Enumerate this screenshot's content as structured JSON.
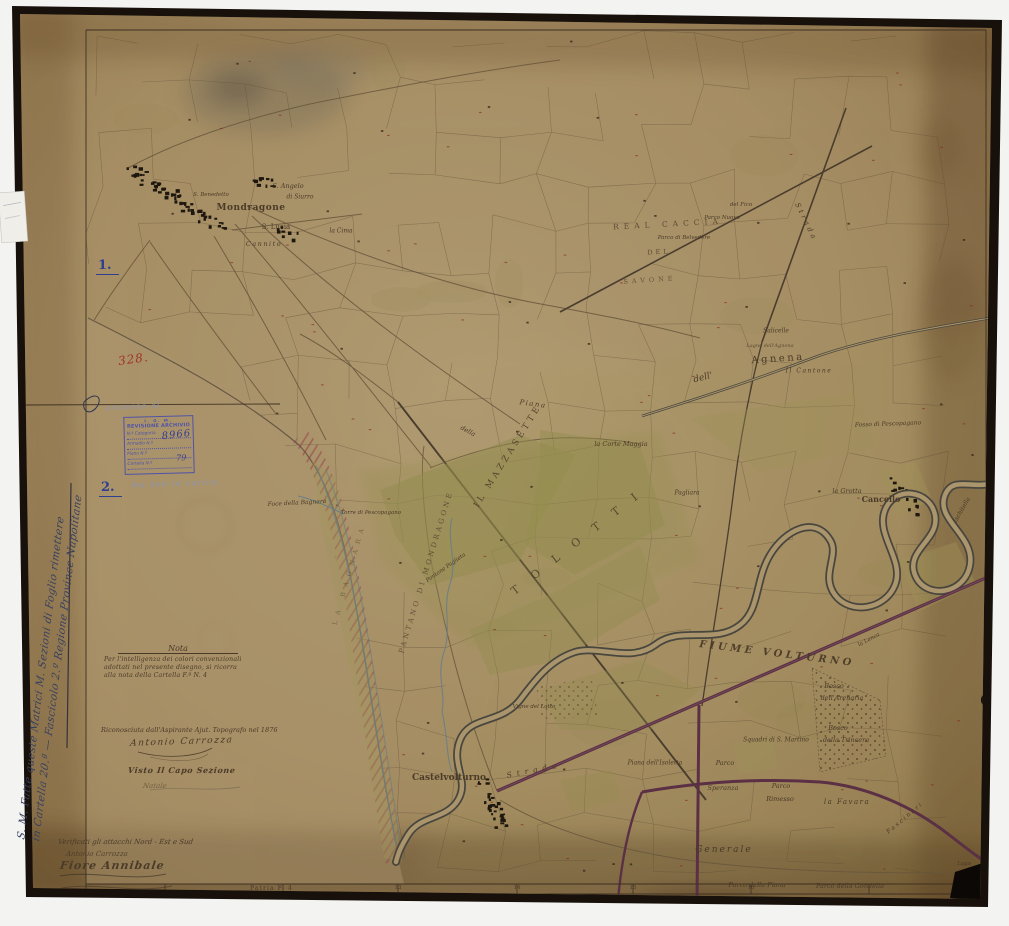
{
  "colors": {
    "paper": "#c8ac7a",
    "ink": "#4a3a28",
    "blue_ink": "#2e3f8f",
    "red_ink": "#9e3425",
    "stamp_blue": "#4f52a8",
    "road_purple": "#6e3a52",
    "river_gray": "#57544a",
    "channel_blue": "#7e98a0",
    "field_green": "#b0a85e",
    "dune_red": "#b05056"
  },
  "margin": {
    "item1": "1.",
    "item2": "2.",
    "number_red": "328.",
    "rotated_note": {
      "line1": "S. M. Fatte queste Matrici M. Sezioni di Foglio rimettere",
      "line2": "in Cartella 20.ª — Fascicolo 2.º Regione Province Napolitane"
    },
    "pencil_above_stamp": "annesso al",
    "pencil_below_stamp": "ma non in carico",
    "stamp": {
      "line1": "I. G. M.",
      "line2": "REVISIONE ARCHIVIO",
      "rows": [
        {
          "label": "N.ª Categoria",
          "value": "8966"
        },
        {
          "label": "Armadio N.º",
          "value": ""
        },
        {
          "label": "Piano N.º",
          "value": "79"
        },
        {
          "label": "Cartella N.º",
          "value": ""
        }
      ]
    },
    "nota": {
      "title": "Nota",
      "lines": [
        "Per l'intelligenza dei colori convenzionali",
        "adottati nel presente disegno, si ricorra",
        "alla nota della Cartella F.ª N. 4"
      ]
    },
    "recognition": {
      "line": "Riconosciuta dall'Aspirante Ajut. Topografo nel 1876",
      "signature": "Antonio Carrozza"
    },
    "visto": {
      "line": "Visto Il Capo Sezione",
      "signature": "Natale"
    },
    "verification": {
      "lines": [
        "Verificati gli attacchi Nord - Est e Sud",
        "Antonio Carrozza",
        "Fiore Annibale"
      ]
    }
  },
  "border": {
    "bottom_label": "Patria F. 4",
    "ticks": [
      {
        "label": "13",
        "x": 398
      },
      {
        "label": "14",
        "x": 517
      },
      {
        "label": "15",
        "x": 633
      },
      {
        "label": "16",
        "x": 751
      }
    ]
  },
  "map": {
    "labels": [
      {
        "t": "Mondragone",
        "x": 251,
        "y": 208,
        "s": 9,
        "st": "rm",
        "ls": 0.5,
        "w": 700
      },
      {
        "t": "S. Angelo",
        "x": 288,
        "y": 186,
        "s": 6.5
      },
      {
        "t": "di Siurro",
        "x": 300,
        "y": 197,
        "s": 6
      },
      {
        "t": "S. Lucia",
        "x": 276,
        "y": 227,
        "s": 7,
        "st": "rm"
      },
      {
        "t": "S. Benedetto",
        "x": 211,
        "y": 195,
        "s": 5.5
      },
      {
        "t": "la Cima",
        "x": 341,
        "y": 231,
        "s": 6
      },
      {
        "t": "Cannito",
        "x": 264,
        "y": 244,
        "s": 6.5,
        "ls": 1.5
      },
      {
        "t": "IL MAZZASETTE",
        "x": 508,
        "y": 456,
        "r": -58,
        "s": 8.5,
        "ls": 3.5,
        "st": "rm",
        "o": 0.9
      },
      {
        "t": "T O L O T T I",
        "x": 577,
        "y": 542,
        "r": -38,
        "s": 11,
        "ls": 7,
        "st": "rm",
        "o": 0.85
      },
      {
        "t": "PANTANO DI MONDRAGONE",
        "x": 426,
        "y": 572,
        "r": -73,
        "s": 7,
        "ls": 3,
        "st": "rm",
        "o": 0.75
      },
      {
        "t": "LA BAGNARA",
        "x": 349,
        "y": 574,
        "r": -74,
        "s": 6.5,
        "ls": 6,
        "st": "rm",
        "o": 0.5
      },
      {
        "t": "FIUME VOLTURNO",
        "x": 777,
        "y": 654,
        "r": 7,
        "s": 10,
        "ls": 3.5,
        "w": 700,
        "o": 0.95
      },
      {
        "t": "Agnena",
        "x": 778,
        "y": 359,
        "r": -4,
        "s": 10,
        "ls": 2.5,
        "st": "rm"
      },
      {
        "t": "Lagno dell'Agnena",
        "x": 770,
        "y": 346,
        "s": 5,
        "o": 0.8
      },
      {
        "t": "dell'",
        "x": 703,
        "y": 378,
        "r": -15,
        "s": 9
      },
      {
        "t": "Il Cantone",
        "x": 809,
        "y": 371,
        "s": 6,
        "ls": 1.5
      },
      {
        "t": "REAL CACCIA",
        "x": 668,
        "y": 224,
        "r": -3,
        "s": 7.5,
        "ls": 5,
        "st": "rm",
        "o": 0.8
      },
      {
        "t": "DEL",
        "x": 659,
        "y": 252,
        "r": -3,
        "s": 6.5,
        "ls": 3,
        "st": "rm",
        "o": 0.8
      },
      {
        "t": "SAVONE",
        "x": 650,
        "y": 280,
        "r": -4,
        "s": 6.5,
        "ls": 4,
        "st": "rm",
        "o": 0.7
      },
      {
        "t": "del Fico",
        "x": 741,
        "y": 205,
        "s": 5.5
      },
      {
        "t": "Parco Nuovo",
        "x": 722,
        "y": 218,
        "s": 5.5
      },
      {
        "t": "Parco di Belvedere",
        "x": 684,
        "y": 238,
        "s": 5.5
      },
      {
        "t": "Salicelle",
        "x": 776,
        "y": 331,
        "s": 6
      },
      {
        "t": "Strada",
        "x": 806,
        "y": 222,
        "r": 64,
        "s": 7,
        "ls": 3
      },
      {
        "t": "Fosso di Pescopagano",
        "x": 888,
        "y": 424,
        "r": -2,
        "s": 6
      },
      {
        "t": "la Grotta",
        "x": 847,
        "y": 491,
        "s": 6.5
      },
      {
        "t": "Cancello",
        "x": 881,
        "y": 499,
        "s": 8,
        "st": "rm",
        "w": 700
      },
      {
        "t": "Ischitella",
        "x": 962,
        "y": 510,
        "r": -60,
        "s": 6
      },
      {
        "t": "la Lanca",
        "x": 869,
        "y": 640,
        "r": -28,
        "s": 5.5
      },
      {
        "t": "Piana",
        "x": 533,
        "y": 404,
        "r": 8,
        "s": 7,
        "ls": 1.5
      },
      {
        "t": "della",
        "x": 468,
        "y": 431,
        "r": 28,
        "s": 6.5
      },
      {
        "t": "la Corte Maggia",
        "x": 621,
        "y": 444,
        "s": 6.5
      },
      {
        "t": "Pagliara",
        "x": 687,
        "y": 493,
        "s": 6
      },
      {
        "t": "Pontone Paglieta",
        "x": 446,
        "y": 568,
        "r": -35,
        "s": 5.5
      },
      {
        "t": "Foce della Bagnara",
        "x": 297,
        "y": 503,
        "r": -3,
        "s": 6
      },
      {
        "t": "Torre di Pescopagano",
        "x": 371,
        "y": 513,
        "s": 5.5
      },
      {
        "t": "Vigne del Lotto",
        "x": 534,
        "y": 707,
        "s": 5.5
      },
      {
        "t": "Strada",
        "x": 534,
        "y": 770,
        "r": -11,
        "s": 7.5,
        "ls": 5
      },
      {
        "t": "Castelvolturno",
        "x": 449,
        "y": 778,
        "s": 9,
        "st": "rm",
        "w": 700
      },
      {
        "t": "Piana dell'Isoletta",
        "x": 655,
        "y": 763,
        "s": 6
      },
      {
        "t": "Squadri di S. Martino",
        "x": 776,
        "y": 740,
        "s": 6
      },
      {
        "t": "Bosco",
        "x": 838,
        "y": 728,
        "s": 6.5
      },
      {
        "t": "della Trincera",
        "x": 846,
        "y": 740,
        "s": 6.5
      },
      {
        "t": "Bosco",
        "x": 834,
        "y": 686,
        "s": 6.5
      },
      {
        "t": "dell'Arenaria",
        "x": 842,
        "y": 698,
        "s": 6.5
      },
      {
        "t": "la Favara",
        "x": 847,
        "y": 802,
        "s": 7,
        "ls": 1.5
      },
      {
        "t": "Parco",
        "x": 725,
        "y": 763,
        "s": 6.5
      },
      {
        "t": "Speranza",
        "x": 723,
        "y": 788,
        "s": 6.5
      },
      {
        "t": "Parco",
        "x": 781,
        "y": 786,
        "s": 6.5
      },
      {
        "t": "Rimesso",
        "x": 780,
        "y": 799,
        "s": 6.5
      },
      {
        "t": "Generale",
        "x": 724,
        "y": 850,
        "s": 9,
        "ls": 2
      },
      {
        "t": "Parco della Piana",
        "x": 757,
        "y": 885,
        "s": 6.5
      },
      {
        "t": "Parco della Gondella",
        "x": 850,
        "y": 886,
        "s": 6.5
      },
      {
        "t": "Fascinari",
        "x": 905,
        "y": 818,
        "r": -40,
        "s": 6,
        "ls": 2
      },
      {
        "t": "Lago",
        "x": 964,
        "y": 864,
        "s": 5.5
      }
    ]
  }
}
